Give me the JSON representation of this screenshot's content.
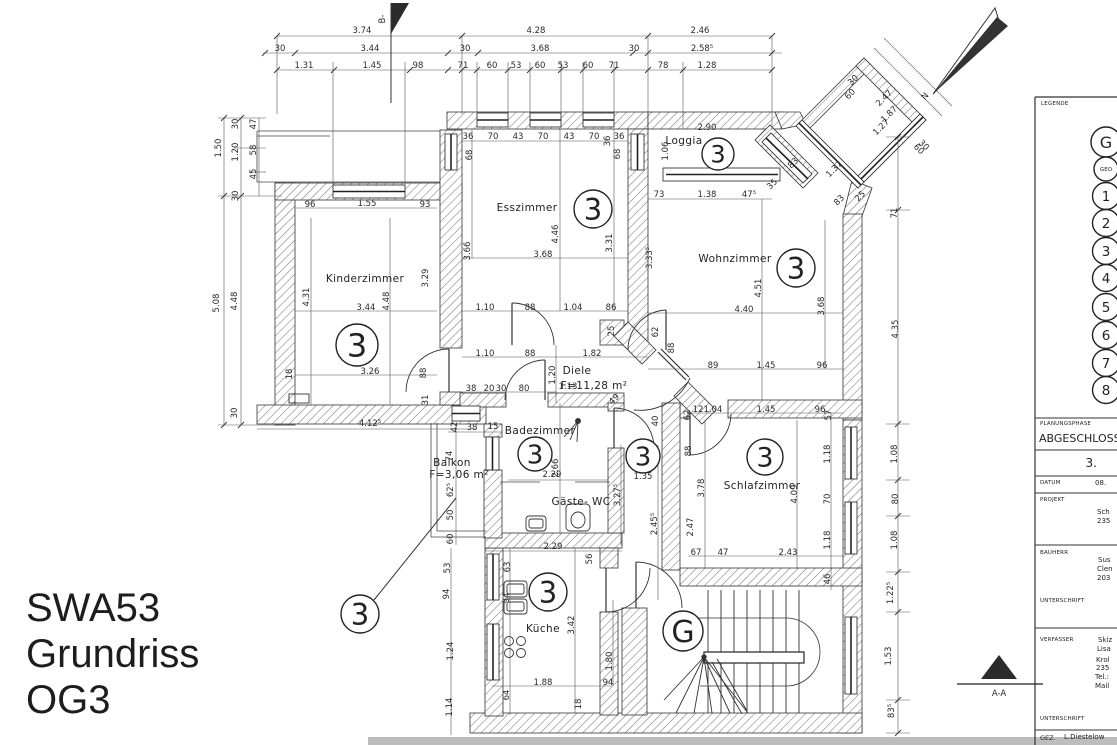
{
  "page": {
    "title_lines": [
      "SWA53",
      "Grundriss",
      "OG3"
    ]
  },
  "plan": {
    "room_labels": [
      {
        "t": "Kinderzimmer",
        "x": 365,
        "y": 282
      },
      {
        "t": "Esszimmer",
        "x": 527,
        "y": 211
      },
      {
        "t": "Wohnzimmer",
        "x": 735,
        "y": 262
      },
      {
        "t": "Loggia",
        "x": 684,
        "y": 144
      },
      {
        "t": "Diele",
        "x": 577,
        "y": 374
      },
      {
        "t": "F=11,28 m²",
        "x": 594,
        "y": 389,
        "s": 8.5
      },
      {
        "t": "Badezimmer",
        "x": 540,
        "y": 434
      },
      {
        "t": "Gäste- WC",
        "x": 581,
        "y": 505
      },
      {
        "t": "Schlafzimmer",
        "x": 762,
        "y": 489
      },
      {
        "t": "Küche",
        "x": 543,
        "y": 632
      },
      {
        "t": "Balkon",
        "x": 452,
        "y": 466
      },
      {
        "t": "F=3,06 m²",
        "x": 459,
        "y": 478,
        "s": 8.5
      }
    ],
    "markers": [
      {
        "t": "3",
        "x": 357,
        "y": 345,
        "rad": 21
      },
      {
        "t": "3",
        "x": 593,
        "y": 209,
        "rad": 19
      },
      {
        "t": "3",
        "x": 718,
        "y": 154,
        "rad": 16
      },
      {
        "t": "3",
        "x": 796,
        "y": 268,
        "rad": 19
      },
      {
        "t": "3",
        "x": 535,
        "y": 454,
        "rad": 17
      },
      {
        "t": "3",
        "x": 643,
        "y": 456,
        "rad": 17
      },
      {
        "t": "3",
        "x": 765,
        "y": 457,
        "rad": 18
      },
      {
        "t": "3",
        "x": 548,
        "y": 592,
        "rad": 19
      },
      {
        "t": "3",
        "x": 360,
        "y": 614,
        "rad": 19,
        "leader": [
          374,
          600,
          456,
          498
        ]
      },
      {
        "t": "G",
        "x": 683,
        "y": 631,
        "rad": 20
      }
    ],
    "dimensions": [
      {
        "t": "3.74",
        "x": 362,
        "y": 33
      },
      {
        "t": "4.28",
        "x": 536,
        "y": 33
      },
      {
        "t": "2.46",
        "x": 700,
        "y": 33
      },
      {
        "t": "30",
        "x": 280,
        "y": 51
      },
      {
        "t": "3.44",
        "x": 370,
        "y": 51
      },
      {
        "t": "30",
        "x": 465,
        "y": 51
      },
      {
        "t": "3.68",
        "x": 540,
        "y": 51
      },
      {
        "t": "30",
        "x": 634,
        "y": 51
      },
      {
        "t": "2.58⁵",
        "x": 702,
        "y": 51
      },
      {
        "t": "1.31",
        "x": 304,
        "y": 68
      },
      {
        "t": "1.45",
        "x": 372,
        "y": 68
      },
      {
        "t": "98",
        "x": 418,
        "y": 68
      },
      {
        "t": "71",
        "x": 463,
        "y": 68
      },
      {
        "t": "60",
        "x": 492,
        "y": 68
      },
      {
        "t": "53",
        "x": 516,
        "y": 68
      },
      {
        "t": "60",
        "x": 540,
        "y": 68
      },
      {
        "t": "53",
        "x": 563,
        "y": 68
      },
      {
        "t": "60",
        "x": 588,
        "y": 68
      },
      {
        "t": "71",
        "x": 614,
        "y": 68
      },
      {
        "t": "78",
        "x": 663,
        "y": 68
      },
      {
        "t": "1.28",
        "x": 707,
        "y": 68
      },
      {
        "t": "30",
        "x": 238,
        "y": 124,
        "r": -90
      },
      {
        "t": "47",
        "x": 256,
        "y": 124,
        "r": -90
      },
      {
        "t": "1.50",
        "x": 221,
        "y": 148,
        "r": -90
      },
      {
        "t": "1.20",
        "x": 238,
        "y": 152,
        "r": -90
      },
      {
        "t": "58",
        "x": 256,
        "y": 150,
        "r": -90
      },
      {
        "t": "45",
        "x": 256,
        "y": 174,
        "r": -90
      },
      {
        "t": "30",
        "x": 238,
        "y": 196,
        "r": -90
      },
      {
        "t": "5.08",
        "x": 219,
        "y": 303,
        "r": -90
      },
      {
        "t": "4.48",
        "x": 237,
        "y": 301,
        "r": -90
      },
      {
        "t": "30",
        "x": 237,
        "y": 413,
        "r": -90
      },
      {
        "t": "96",
        "x": 310,
        "y": 207
      },
      {
        "t": "1.55",
        "x": 367,
        "y": 206
      },
      {
        "t": "93",
        "x": 425,
        "y": 207
      },
      {
        "t": "4.31",
        "x": 309,
        "y": 297,
        "r": -90
      },
      {
        "t": "3.44",
        "x": 366,
        "y": 310
      },
      {
        "t": "4.48",
        "x": 389,
        "y": 301,
        "r": -90
      },
      {
        "t": "3.29",
        "x": 428,
        "y": 278,
        "r": -90
      },
      {
        "t": "18",
        "x": 292,
        "y": 374,
        "r": -90
      },
      {
        "t": "3.26",
        "x": 370,
        "y": 374
      },
      {
        "t": "88",
        "x": 426,
        "y": 373,
        "r": -90
      },
      {
        "t": "31",
        "x": 428,
        "y": 400,
        "r": -90
      },
      {
        "t": "4.12⁵",
        "x": 370,
        "y": 426
      },
      {
        "t": "42",
        "x": 457,
        "y": 427,
        "r": -90
      },
      {
        "t": "38",
        "x": 472,
        "y": 430
      },
      {
        "t": "36",
        "x": 468,
        "y": 139
      },
      {
        "t": "70",
        "x": 493,
        "y": 139
      },
      {
        "t": "43",
        "x": 518,
        "y": 139
      },
      {
        "t": "70",
        "x": 543,
        "y": 139
      },
      {
        "t": "43",
        "x": 569,
        "y": 139
      },
      {
        "t": "70",
        "x": 594,
        "y": 139
      },
      {
        "t": "36",
        "x": 619,
        "y": 139
      },
      {
        "t": "68",
        "x": 472,
        "y": 155,
        "r": -90
      },
      {
        "t": "36",
        "x": 610,
        "y": 141,
        "r": -90
      },
      {
        "t": "68",
        "x": 620,
        "y": 154,
        "r": -90
      },
      {
        "t": "3.66",
        "x": 470,
        "y": 251,
        "r": -90
      },
      {
        "t": "4.46",
        "x": 558,
        "y": 234,
        "r": -90
      },
      {
        "t": "3.31",
        "x": 612,
        "y": 243,
        "r": -90
      },
      {
        "t": "3.68",
        "x": 543,
        "y": 257
      },
      {
        "t": "1.10",
        "x": 485,
        "y": 310
      },
      {
        "t": "88",
        "x": 530,
        "y": 310
      },
      {
        "t": "1.04",
        "x": 573,
        "y": 310
      },
      {
        "t": "86",
        "x": 611,
        "y": 310
      },
      {
        "t": "25",
        "x": 614,
        "y": 331,
        "r": -90
      },
      {
        "t": "1.10",
        "x": 485,
        "y": 356
      },
      {
        "t": "88",
        "x": 530,
        "y": 356
      },
      {
        "t": "1.82",
        "x": 592,
        "y": 356
      },
      {
        "t": "1.06",
        "x": 668,
        "y": 151,
        "r": -90
      },
      {
        "t": "2.90",
        "x": 707,
        "y": 130
      },
      {
        "t": "73",
        "x": 659,
        "y": 197
      },
      {
        "t": "1.38",
        "x": 707,
        "y": 197
      },
      {
        "t": "47⁵",
        "x": 749,
        "y": 197
      },
      {
        "t": "3.33⁵",
        "x": 652,
        "y": 258,
        "r": -90
      },
      {
        "t": "35",
        "x": 774,
        "y": 186,
        "r": -45
      },
      {
        "t": "83",
        "x": 795,
        "y": 165,
        "r": -45
      },
      {
        "t": "1.37",
        "x": 836,
        "y": 171,
        "r": -45
      },
      {
        "t": "83",
        "x": 841,
        "y": 202,
        "r": -45
      },
      {
        "t": "25",
        "x": 862,
        "y": 198,
        "r": -45
      },
      {
        "t": "30",
        "x": 855,
        "y": 82,
        "r": -45
      },
      {
        "t": "60",
        "x": 852,
        "y": 96,
        "r": -45
      },
      {
        "t": "2.47",
        "x": 886,
        "y": 100,
        "r": -45
      },
      {
        "t": "1.87",
        "x": 891,
        "y": 116,
        "r": -45
      },
      {
        "t": "1.27",
        "x": 883,
        "y": 129,
        "r": -45
      },
      {
        "t": "30",
        "x": 922,
        "y": 147,
        "r": 45
      },
      {
        "t": "60",
        "x": 917,
        "y": 151,
        "r": 45
      },
      {
        "t": "4.51",
        "x": 761,
        "y": 288,
        "r": -90
      },
      {
        "t": "4.40",
        "x": 744,
        "y": 312
      },
      {
        "t": "3.68",
        "x": 824,
        "y": 306,
        "r": -90
      },
      {
        "t": "62",
        "x": 658,
        "y": 332,
        "r": -90
      },
      {
        "t": "88",
        "x": 674,
        "y": 348,
        "r": -90
      },
      {
        "t": "89",
        "x": 713,
        "y": 368
      },
      {
        "t": "1.45",
        "x": 766,
        "y": 368
      },
      {
        "t": "96",
        "x": 822,
        "y": 368
      },
      {
        "t": "71",
        "x": 897,
        "y": 213,
        "r": -90
      },
      {
        "t": "4.35",
        "x": 898,
        "y": 329,
        "r": -90
      },
      {
        "t": "1.20",
        "x": 555,
        "y": 375,
        "r": -90
      },
      {
        "t": "1.13",
        "x": 568,
        "y": 389
      },
      {
        "t": "49",
        "x": 616,
        "y": 401,
        "r": -45
      },
      {
        "t": "40",
        "x": 658,
        "y": 421,
        "r": -90
      },
      {
        "t": "62",
        "x": 690,
        "y": 415,
        "r": -90
      },
      {
        "t": "12",
        "x": 698,
        "y": 412
      },
      {
        "t": "1.04",
        "x": 713,
        "y": 412
      },
      {
        "t": "38",
        "x": 471,
        "y": 391
      },
      {
        "t": "20",
        "x": 489,
        "y": 391
      },
      {
        "t": "30",
        "x": 501,
        "y": 391
      },
      {
        "t": "80",
        "x": 524,
        "y": 391
      },
      {
        "t": "15",
        "x": 493,
        "y": 429
      },
      {
        "t": "2.66",
        "x": 558,
        "y": 468,
        "r": -90
      },
      {
        "t": "2.29",
        "x": 552,
        "y": 477
      },
      {
        "t": "74",
        "x": 452,
        "y": 456,
        "r": -90
      },
      {
        "t": "62⁵",
        "x": 453,
        "y": 490,
        "r": -90
      },
      {
        "t": "50",
        "x": 453,
        "y": 515,
        "r": -90
      },
      {
        "t": "60",
        "x": 453,
        "y": 539,
        "r": -90
      },
      {
        "t": "1.35",
        "x": 643,
        "y": 479
      },
      {
        "t": "3.27⁵",
        "x": 620,
        "y": 495,
        "r": -90
      },
      {
        "t": "2.45⁵",
        "x": 657,
        "y": 524,
        "r": -90
      },
      {
        "t": "2.29",
        "x": 553,
        "y": 549
      },
      {
        "t": "1.45",
        "x": 766,
        "y": 412
      },
      {
        "t": "96",
        "x": 820,
        "y": 412
      },
      {
        "t": "57",
        "x": 831,
        "y": 415,
        "r": -90
      },
      {
        "t": "88",
        "x": 691,
        "y": 451,
        "r": -90
      },
      {
        "t": "3.78",
        "x": 704,
        "y": 488,
        "r": -90
      },
      {
        "t": "4.09",
        "x": 797,
        "y": 494,
        "r": -90
      },
      {
        "t": "2.47",
        "x": 693,
        "y": 527,
        "r": -90
      },
      {
        "t": "1.18",
        "x": 830,
        "y": 454,
        "r": -90
      },
      {
        "t": "70",
        "x": 830,
        "y": 499,
        "r": -90
      },
      {
        "t": "1.18",
        "x": 830,
        "y": 540,
        "r": -90
      },
      {
        "t": "67",
        "x": 696,
        "y": 555
      },
      {
        "t": "47",
        "x": 723,
        "y": 555
      },
      {
        "t": "2.43",
        "x": 788,
        "y": 555
      },
      {
        "t": "46",
        "x": 830,
        "y": 579,
        "r": -90
      },
      {
        "t": "1.08",
        "x": 897,
        "y": 454,
        "r": -90
      },
      {
        "t": "80",
        "x": 898,
        "y": 499,
        "r": -90
      },
      {
        "t": "1.08",
        "x": 897,
        "y": 540,
        "r": -90
      },
      {
        "t": "56",
        "x": 592,
        "y": 559,
        "r": -90
      },
      {
        "t": "63",
        "x": 510,
        "y": 567,
        "r": -90
      },
      {
        "t": "53",
        "x": 450,
        "y": 568,
        "r": -90
      },
      {
        "t": "94",
        "x": 449,
        "y": 594,
        "r": -90
      },
      {
        "t": "94",
        "x": 509,
        "y": 598,
        "r": -90
      },
      {
        "t": "3.42",
        "x": 574,
        "y": 625,
        "r": -90
      },
      {
        "t": "1.24",
        "x": 453,
        "y": 651,
        "r": -90
      },
      {
        "t": "1.80",
        "x": 612,
        "y": 661,
        "r": -90
      },
      {
        "t": "1.88",
        "x": 543,
        "y": 685
      },
      {
        "t": "94",
        "x": 608,
        "y": 685
      },
      {
        "t": "64",
        "x": 509,
        "y": 695,
        "r": -90
      },
      {
        "t": "18",
        "x": 581,
        "y": 704,
        "r": -90
      },
      {
        "t": "1.14",
        "x": 452,
        "y": 707,
        "r": -90
      },
      {
        "t": "1.22⁵",
        "x": 893,
        "y": 593,
        "r": -90
      },
      {
        "t": "1.53",
        "x": 891,
        "y": 656,
        "r": -90
      },
      {
        "t": "83⁵",
        "x": 894,
        "y": 711,
        "r": -90
      },
      {
        "t": "N",
        "x": 927,
        "y": 98,
        "r": -48,
        "s": 12
      },
      {
        "t": "B-",
        "x": 385,
        "y": 19,
        "r": -90,
        "s": 8
      },
      {
        "t": "A-A",
        "x": 999,
        "y": 696,
        "s": 8
      }
    ]
  },
  "legend": {
    "title": "LEGENDE",
    "items": [
      "G",
      "GEO",
      "1",
      "2",
      "3",
      "4",
      "5",
      "6",
      "7",
      "8"
    ]
  },
  "titleblock": {
    "planungsphase_label": "PLANUNGSPHASE",
    "planungsphase_value": "ABGESCHLOSS",
    "phase_number": "3.",
    "datum_label": "DATUM",
    "datum_value": "08.",
    "projekt_label": "PROJEKT",
    "projekt_lines": [
      "Sch",
      "235"
    ],
    "bauherr_label": "BAUHERR",
    "bauherr_lines": [
      "Sus",
      "Clen",
      "203"
    ],
    "unterschrift_label": "UNTERSCHRIFT",
    "verfasser_label": "VERFASSER",
    "verfasser_lines": [
      "Skiz",
      "Lisa",
      "Krol",
      "235",
      "Tel.:",
      "Mail"
    ],
    "unterschrift2_label": "UNTERSCHRIFT",
    "gez_label": "GEZ.",
    "gez_value": "L.Diestelow"
  }
}
